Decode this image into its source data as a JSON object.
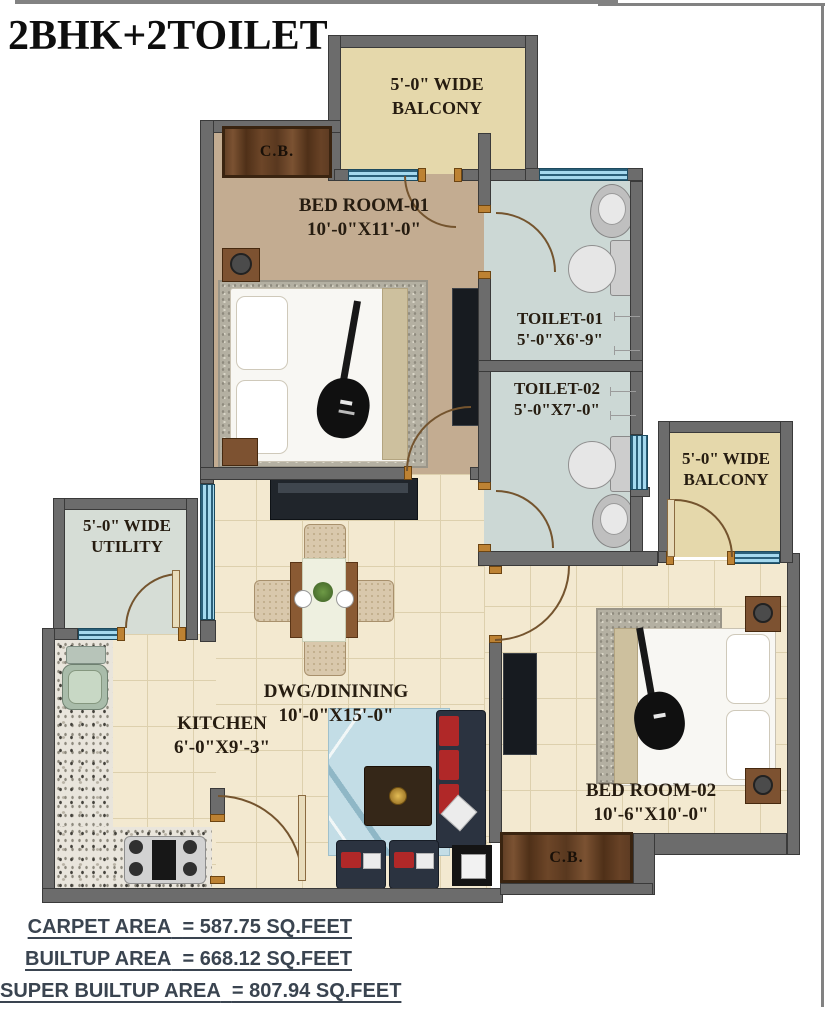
{
  "title": "2BHK+2TOILET",
  "rooms": {
    "balcony_top": {
      "line1": "5'-0\" WIDE",
      "line2": "BALCONY"
    },
    "balcony_right": {
      "line1": "5'-0\" WIDE",
      "line2": "BALCONY"
    },
    "utility": {
      "line1": "5'-0\" WIDE",
      "line2": "UTILITY"
    },
    "bedroom1": {
      "name": "BED ROOM-01",
      "dims": "10'-0\"X11'-0\""
    },
    "bedroom2": {
      "name": "BED ROOM-02",
      "dims": "10'-6\"X10'-0\""
    },
    "toilet1": {
      "name": "TOILET-01",
      "dims": "5'-0\"X6'-9\""
    },
    "toilet2": {
      "name": "TOILET-02",
      "dims": "5'-0\"X7'-0\""
    },
    "dining": {
      "name": "DWG/DININING",
      "dims": "10'-0\"X15'-0\""
    },
    "kitchen": {
      "name": "KITCHEN",
      "dims": "6'-0\"X9'-3\""
    },
    "cupboard1": {
      "name": "C.B."
    },
    "cupboard2": {
      "name": "C.B."
    }
  },
  "areas": {
    "carpet": {
      "label": "CARPET AREA",
      "value": "= 587.75 SQ.FEET"
    },
    "builtup": {
      "label": "BUILTUP AREA",
      "value": "= 668.12 SQ.FEET"
    },
    "super_builtup": {
      "label": "SUPER BUILTUP AREA",
      "value": "= 807.94 SQ.FEET"
    }
  },
  "colors": {
    "wall": "#6c6c6c",
    "window": "#a5d9ee",
    "bedroom1_floor": "#c3ac91",
    "tile_floor": "#f3e9d0",
    "toilet_floor": "#ccd8d5",
    "balcony_floor": "#e5d8ab",
    "utility_floor": "#d6ddd6",
    "wood": "#6d4628",
    "area_text": "#3a4450"
  }
}
